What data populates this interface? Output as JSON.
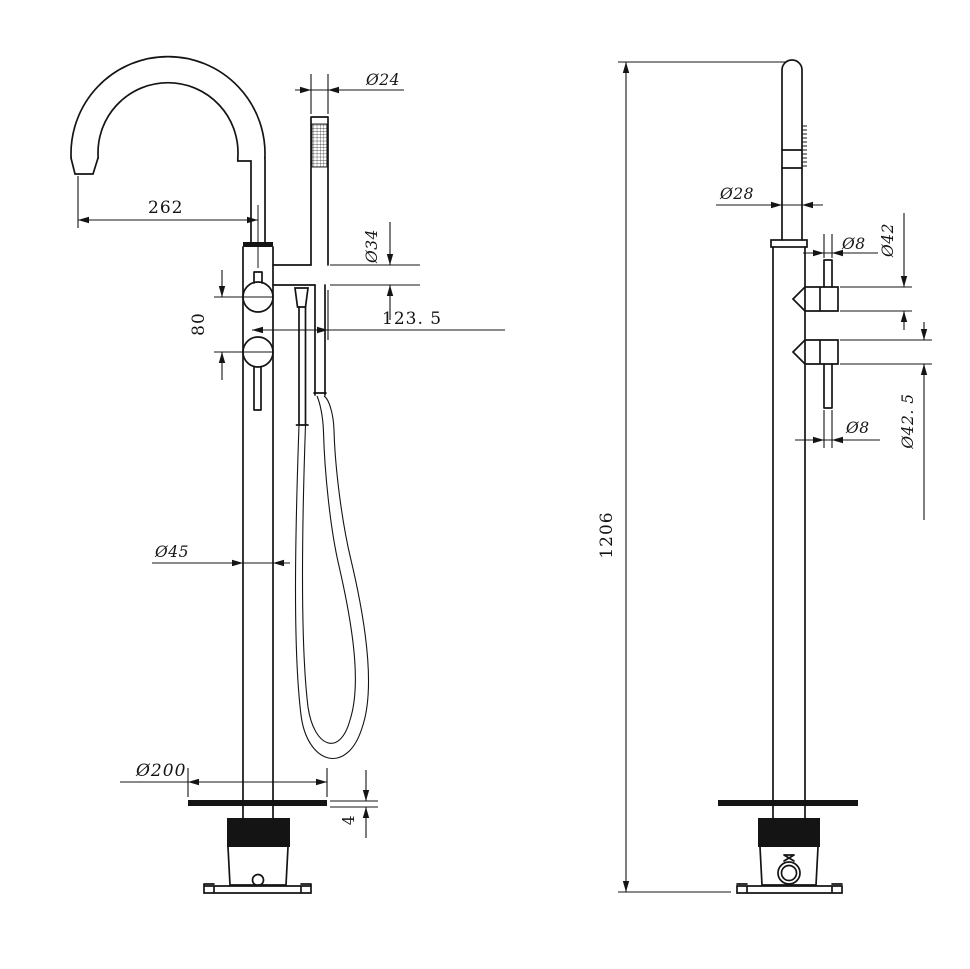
{
  "drawing": {
    "background": "#ffffff",
    "line_color": "#141414",
    "views": {
      "front": {
        "name": "front-view-freestanding-bath-filler",
        "dims": {
          "handspray_diameter": "Ø24",
          "spout_reach": "262",
          "holder_diameter": "Ø34",
          "handle_spacing": "80",
          "hose_offset": "123. 5",
          "column_diameter": "Ø45",
          "base_diameter": "Ø200",
          "base_plate_thickness": "4"
        }
      },
      "side": {
        "name": "side-view-freestanding-bath-filler",
        "dims": {
          "riser_diameter": "Ø28",
          "handle_stem_diameter_top": "Ø8",
          "handle_diameter_upper": "Ø42",
          "handle_diameter_lower": "Ø42. 5",
          "handle_stem_diameter_bottom": "Ø8",
          "overall_height": "1206"
        }
      }
    }
  }
}
